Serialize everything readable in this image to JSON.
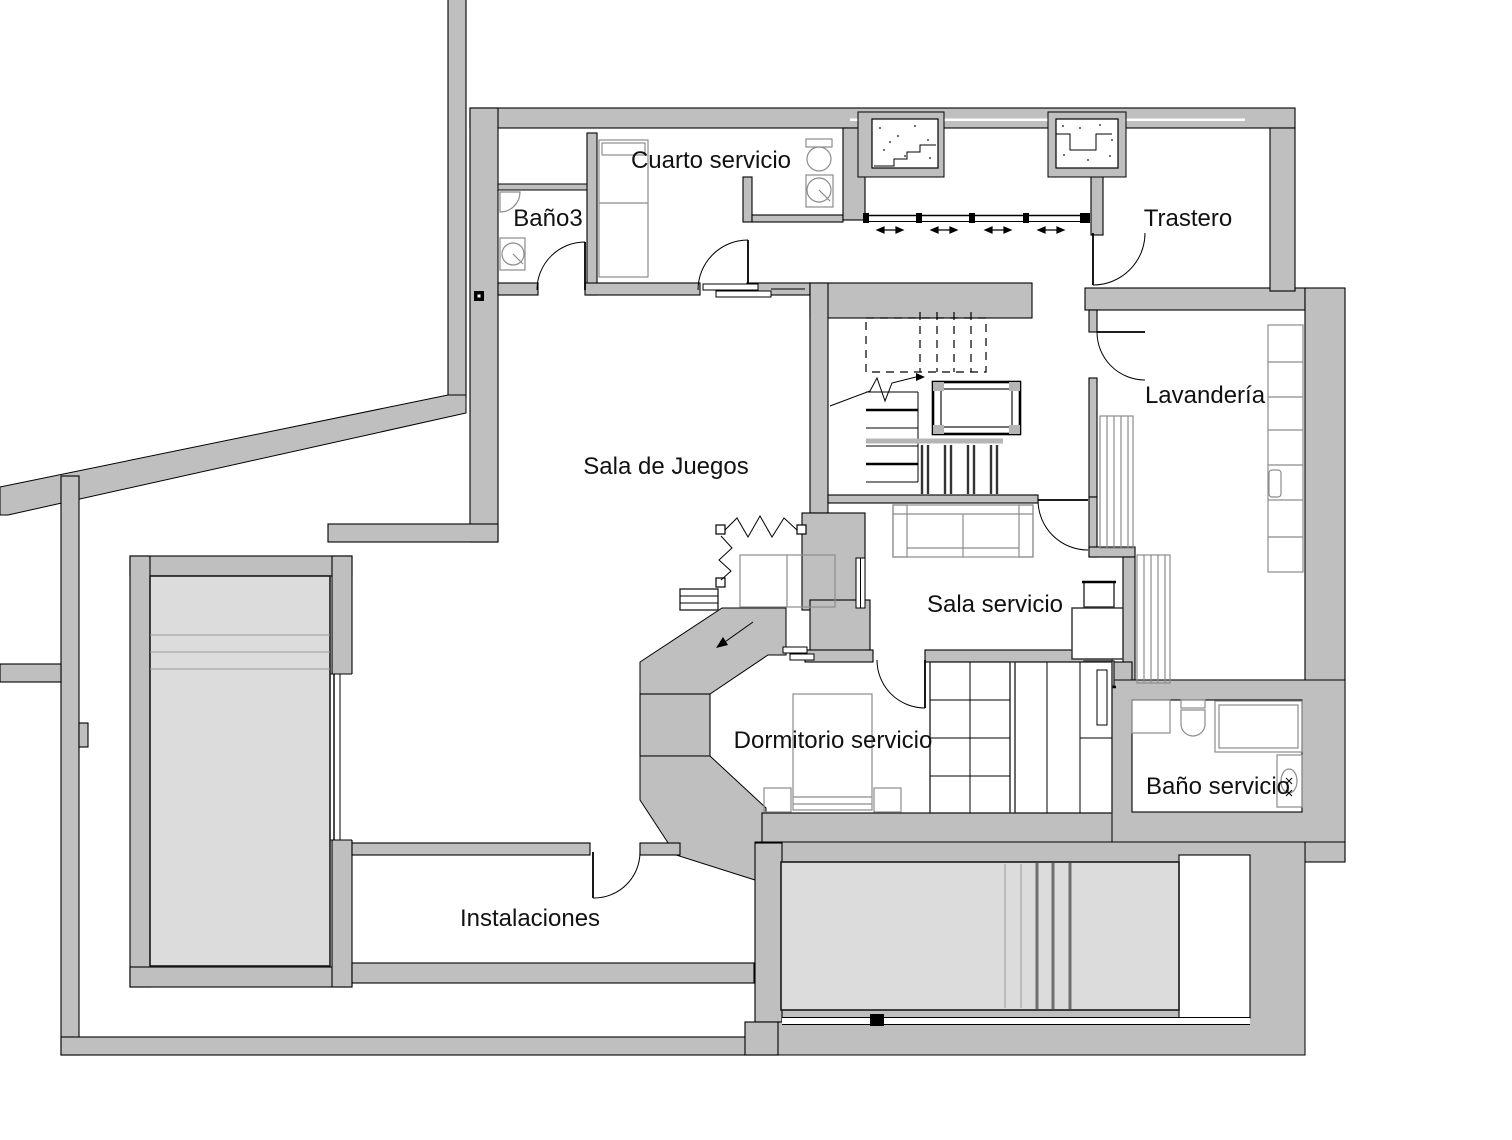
{
  "plan": {
    "rooms": [
      {
        "id": "cuarto-servicio",
        "label": "Cuarto servicio"
      },
      {
        "id": "banio3",
        "label": "Baño3"
      },
      {
        "id": "trastero",
        "label": "Trastero"
      },
      {
        "id": "sala-de-juegos",
        "label": "Sala de Juegos"
      },
      {
        "id": "lavanderia",
        "label": "Lavandería"
      },
      {
        "id": "sala-servicio",
        "label": "Sala servicio"
      },
      {
        "id": "dormitorio-servicio",
        "label": "Dormitorio servicio"
      },
      {
        "id": "banio-servicio",
        "label": "Baño servicio"
      },
      {
        "id": "instalaciones",
        "label": "Instalaciones"
      }
    ]
  },
  "colors": {
    "wall": "#bfbfbf",
    "wall_outline": "#000000",
    "floor": "#ffffff",
    "pool_fill": "#dcdcdc",
    "furniture_line": "#8c8c8c",
    "detail_line": "#000000",
    "label_text": "#111111"
  }
}
